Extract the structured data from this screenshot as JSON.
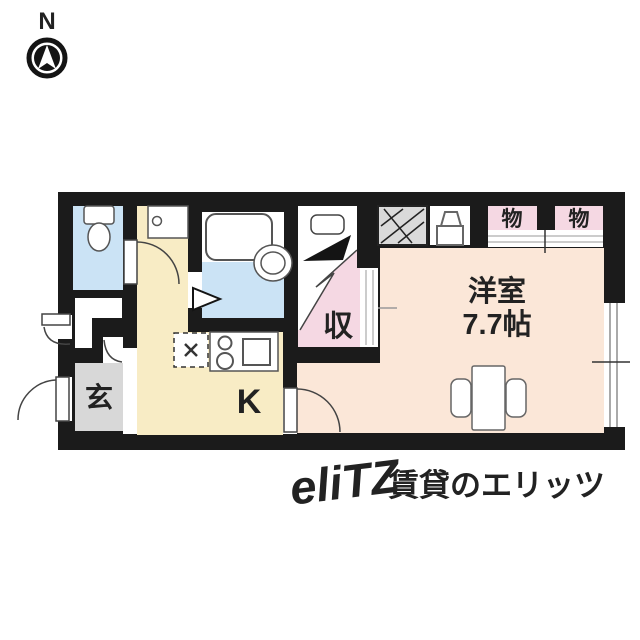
{
  "compass": {
    "label": "N"
  },
  "rooms": {
    "entrance_label": "玄",
    "kitchen_label": "K",
    "closet_label": "収",
    "main_room_name": "洋室",
    "main_room_size": "7.7帖",
    "storage_label_1": "物",
    "storage_label_2": "物"
  },
  "watermark": {
    "logo": "eliTZ",
    "text": "賃貸のエリッツ"
  },
  "colors": {
    "wall": "#1b1b1b",
    "water_blue": "#cbe3f5",
    "kitchen": "#f8ecc5",
    "main_room": "#fbe7d8",
    "pink": "#f5d8e3",
    "entrance_gray": "#d8d8d8",
    "hatch_gray": "#dadada",
    "watermark_gray": "#dcdcdc"
  }
}
